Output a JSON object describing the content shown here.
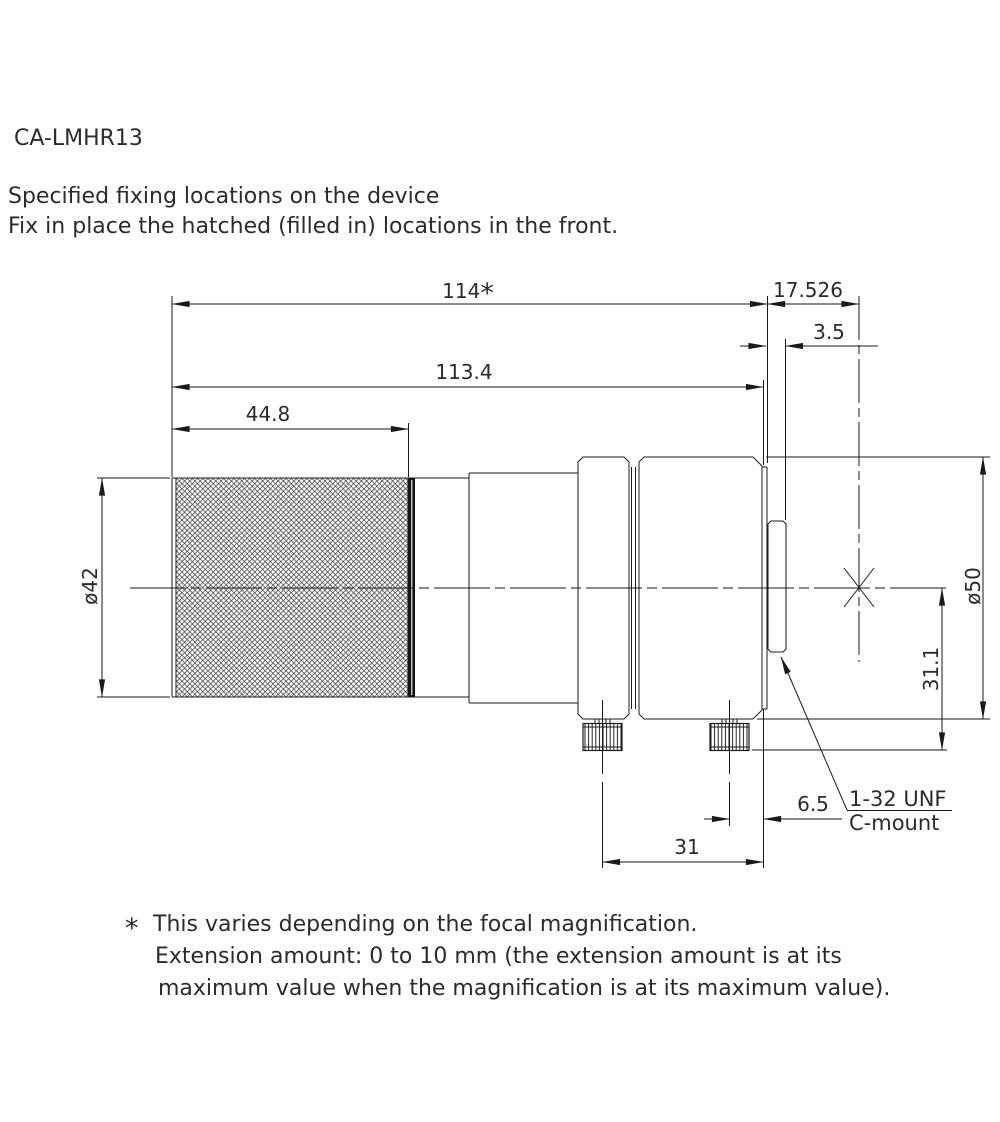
{
  "drawing": {
    "model": "CA-LMHR13",
    "note_line1": "Specified fixing locations on the device",
    "note_line2": "Fix in place the hatched (filled in) locations in the front."
  },
  "dimensions": {
    "total_length": "114",
    "total_length_marker": "*",
    "flange_focal_distance": "17.526",
    "thread_protrusion": "3.5",
    "body_length": "113.4",
    "front_section_length": "44.8",
    "front_diameter": "ø42",
    "rear_diameter": "ø50",
    "axis_to_thumbscrew_bottom": "31.1",
    "thumbscrew2_to_flange": "6.5",
    "thumbscrew1_to_flange": "31"
  },
  "mount_callout": {
    "thread": "1-32 UNF",
    "type": "C-mount"
  },
  "footnote": {
    "marker": "*",
    "line1": "This varies depending on the focal magnification.",
    "line2": "Extension amount: 0 to 10 mm (the extension amount is at its",
    "line3": "maximum value when the magnification is at its maximum value)."
  },
  "colors": {
    "background": "#ffffff",
    "line": "#1a1a1a",
    "text": "#2b2b2b"
  }
}
